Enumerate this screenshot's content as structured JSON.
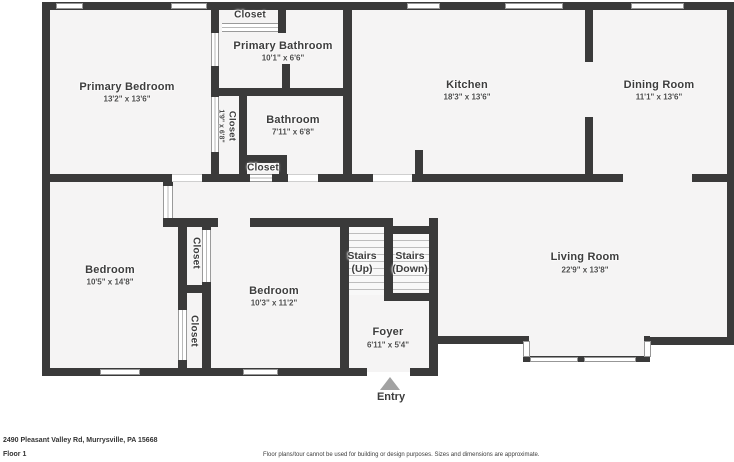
{
  "address": "2490 Pleasant Valley Rd, Murrysville, PA 15668",
  "floor_label": "Floor 1",
  "disclaimer": "Floor plans/tour cannot be used for building or design purposes. Sizes and dimensions are approximate.",
  "entry": {
    "label": "Entry"
  },
  "colors": {
    "wall": "#3a3a3a",
    "room_fill": "#f5f4f4",
    "entry_arrow": "#a2a2a2"
  },
  "rooms": {
    "primary_bedroom": {
      "name": "Primary Bedroom",
      "dims": "13'2\" x 13'6\""
    },
    "closet_top": {
      "name": "Closet"
    },
    "primary_bathroom": {
      "name": "Primary Bathroom",
      "dims": "10'1\" x 6'6\""
    },
    "closet_narrow": {
      "name": "Closet",
      "dims": "1'9\" x 6'8\""
    },
    "bathroom": {
      "name": "Bathroom",
      "dims": "7'11\" x 6'8\""
    },
    "closet_hall": {
      "name": "Closet"
    },
    "kitchen": {
      "name": "Kitchen",
      "dims": "18'3\" x 13'6\""
    },
    "dining_room": {
      "name": "Dining Room",
      "dims": "11'1\" x 13'6\""
    },
    "bedroom_left": {
      "name": "Bedroom",
      "dims": "10'5\" x 14'8\""
    },
    "closet_upper": {
      "name": "Closet"
    },
    "closet_lower": {
      "name": "Closet"
    },
    "bedroom_middle": {
      "name": "Bedroom",
      "dims": "10'3\" x 11'2\""
    },
    "stairs_up": {
      "line1": "Stairs",
      "line2": "(Up)"
    },
    "stairs_down": {
      "line1": "Stairs",
      "line2": "(Down)"
    },
    "foyer": {
      "name": "Foyer",
      "dims": "6'11\" x 5'4\""
    },
    "living_room": {
      "name": "Living Room",
      "dims": "22'9\" x 13'8\""
    }
  }
}
